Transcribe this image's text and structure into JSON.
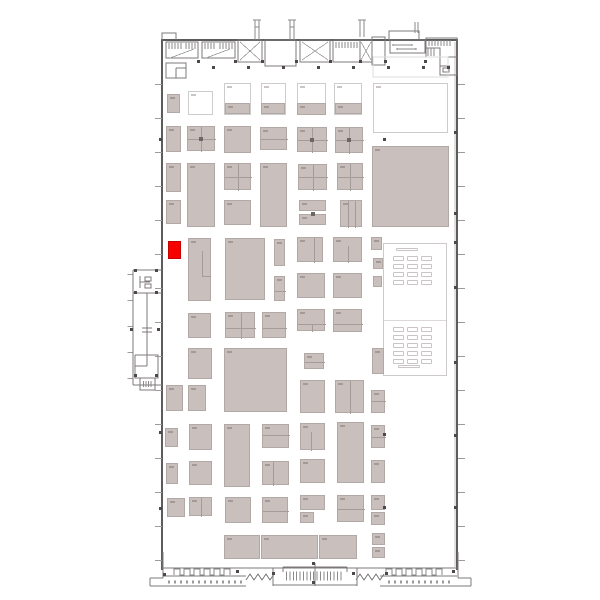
{
  "page": {
    "width": 600,
    "height": 600,
    "background": "#ffffff"
  },
  "colors": {
    "booth_fill": "#c9bfbd",
    "booth_border": "#b2a8a6",
    "outline_border": "#cccccc",
    "highlight": "#f60000",
    "highlight_border": "#c40000",
    "divider": "#a59b99",
    "smudge": "#a39997",
    "smudge_light": "#cdc5c3",
    "wall": "#5c5c5c",
    "line": "#7d7878"
  },
  "floorplan": {
    "hall": {
      "x": 162,
      "y": 38,
      "w": 296,
      "h": 532
    },
    "highlighted_booth": {
      "x": 168,
      "y": 241,
      "w": 13,
      "h": 18,
      "color": "#f60000"
    },
    "booths": [
      {
        "x": 167,
        "y": 94,
        "w": 13,
        "h": 19
      },
      {
        "x": 188,
        "y": 91,
        "w": 25,
        "h": 24,
        "v": "outline"
      },
      {
        "x": 224,
        "y": 83,
        "w": 27,
        "h": 32,
        "v": "outline"
      },
      {
        "x": 225,
        "y": 103,
        "w": 25,
        "h": 11
      },
      {
        "x": 261,
        "y": 83,
        "w": 25,
        "h": 32,
        "v": "outline"
      },
      {
        "x": 261,
        "y": 103,
        "w": 24,
        "h": 11
      },
      {
        "x": 297,
        "y": 83,
        "w": 29,
        "h": 32,
        "v": "outline"
      },
      {
        "x": 297,
        "y": 103,
        "w": 29,
        "h": 12
      },
      {
        "x": 334,
        "y": 83,
        "w": 28,
        "h": 32,
        "v": "outline"
      },
      {
        "x": 335,
        "y": 103,
        "w": 27,
        "h": 11
      },
      {
        "x": 373,
        "y": 83,
        "w": 75,
        "h": 50,
        "v": "outline"
      },
      {
        "x": 166,
        "y": 126,
        "w": 15,
        "h": 26
      },
      {
        "x": 187,
        "y": 126,
        "w": 28,
        "h": 25,
        "bars": [
          [
            13,
            0,
            1,
            25
          ],
          [
            0,
            12,
            28,
            1
          ]
        ],
        "dot": [
          11,
          10
        ]
      },
      {
        "x": 224,
        "y": 126,
        "w": 27,
        "h": 27
      },
      {
        "x": 260,
        "y": 127,
        "w": 27,
        "h": 23,
        "bars": [
          [
            0,
            11,
            27,
            1
          ]
        ]
      },
      {
        "x": 297,
        "y": 127,
        "w": 30,
        "h": 25,
        "bars": [
          [
            14,
            0,
            1,
            25
          ],
          [
            0,
            12,
            30,
            1
          ]
        ],
        "dot": [
          12,
          10
        ]
      },
      {
        "x": 335,
        "y": 127,
        "w": 28,
        "h": 26,
        "bars": [
          [
            13,
            0,
            1,
            26
          ],
          [
            0,
            12,
            28,
            1
          ]
        ],
        "dot": [
          11,
          10
        ]
      },
      {
        "x": 372,
        "y": 146,
        "w": 77,
        "h": 81
      },
      {
        "x": 166,
        "y": 163,
        "w": 15,
        "h": 29
      },
      {
        "x": 187,
        "y": 163,
        "w": 28,
        "h": 64
      },
      {
        "x": 224,
        "y": 163,
        "w": 27,
        "h": 27,
        "bars": [
          [
            13,
            0,
            1,
            27
          ],
          [
            0,
            13,
            27,
            1
          ]
        ]
      },
      {
        "x": 260,
        "y": 163,
        "w": 27,
        "h": 64
      },
      {
        "x": 298,
        "y": 164,
        "w": 29,
        "h": 26,
        "bars": [
          [
            14,
            0,
            1,
            26
          ],
          [
            0,
            12,
            29,
            1
          ]
        ]
      },
      {
        "x": 337,
        "y": 163,
        "w": 26,
        "h": 27,
        "bars": [
          [
            12,
            0,
            1,
            27
          ],
          [
            0,
            13,
            26,
            1
          ]
        ]
      },
      {
        "x": 166,
        "y": 200,
        "w": 15,
        "h": 24
      },
      {
        "x": 224,
        "y": 200,
        "w": 27,
        "h": 25
      },
      {
        "x": 299,
        "y": 200,
        "w": 27,
        "h": 11
      },
      {
        "x": 299,
        "y": 214,
        "w": 27,
        "h": 11,
        "dot": [
          11,
          -3
        ]
      },
      {
        "x": 340,
        "y": 200,
        "w": 22,
        "h": 27,
        "bars": [
          [
            7,
            0,
            1,
            27
          ],
          [
            14,
            0,
            1,
            27
          ]
        ]
      },
      {
        "x": 168,
        "y": 241,
        "w": 13,
        "h": 18,
        "v": "highlight"
      },
      {
        "x": 188,
        "y": 238,
        "w": 23,
        "h": 63,
        "bars": [
          [
            13,
            12,
            1,
            26
          ],
          [
            13,
            37,
            9,
            1
          ]
        ]
      },
      {
        "x": 225,
        "y": 238,
        "w": 40,
        "h": 62
      },
      {
        "x": 274,
        "y": 239,
        "w": 11,
        "h": 27
      },
      {
        "x": 274,
        "y": 276,
        "w": 11,
        "h": 25,
        "bars": [
          [
            0,
            14,
            11,
            1
          ]
        ]
      },
      {
        "x": 297,
        "y": 237,
        "w": 26,
        "h": 25,
        "bars": [
          [
            16,
            0,
            1,
            25
          ]
        ]
      },
      {
        "x": 333,
        "y": 237,
        "w": 29,
        "h": 25,
        "bars": [
          [
            14,
            8,
            1,
            17
          ]
        ]
      },
      {
        "x": 297,
        "y": 273,
        "w": 28,
        "h": 25
      },
      {
        "x": 333,
        "y": 273,
        "w": 29,
        "h": 25
      },
      {
        "x": 371,
        "y": 237,
        "w": 11,
        "h": 13
      },
      {
        "x": 373,
        "y": 258,
        "w": 10,
        "h": 11
      },
      {
        "x": 373,
        "y": 276,
        "w": 9,
        "h": 11
      },
      {
        "x": 188,
        "y": 313,
        "w": 23,
        "h": 25
      },
      {
        "x": 225,
        "y": 312,
        "w": 30,
        "h": 26,
        "bars": [
          [
            15,
            0,
            1,
            26
          ],
          [
            0,
            15,
            30,
            1
          ]
        ]
      },
      {
        "x": 262,
        "y": 312,
        "w": 24,
        "h": 26,
        "bars": [
          [
            0,
            15,
            24,
            1
          ]
        ]
      },
      {
        "x": 297,
        "y": 309,
        "w": 28,
        "h": 22,
        "bars": [
          [
            0,
            14,
            28,
            1
          ],
          [
            14,
            14,
            1,
            8
          ]
        ]
      },
      {
        "x": 333,
        "y": 309,
        "w": 29,
        "h": 23,
        "bars": [
          [
            0,
            14,
            29,
            1
          ]
        ]
      },
      {
        "x": 188,
        "y": 348,
        "w": 24,
        "h": 31
      },
      {
        "x": 224,
        "y": 348,
        "w": 63,
        "h": 64
      },
      {
        "x": 304,
        "y": 353,
        "w": 20,
        "h": 16,
        "bars": [
          [
            0,
            8,
            20,
            1
          ]
        ]
      },
      {
        "x": 372,
        "y": 348,
        "w": 12,
        "h": 26
      },
      {
        "x": 166,
        "y": 385,
        "w": 17,
        "h": 26
      },
      {
        "x": 188,
        "y": 385,
        "w": 18,
        "h": 26
      },
      {
        "x": 300,
        "y": 380,
        "w": 25,
        "h": 33
      },
      {
        "x": 335,
        "y": 380,
        "w": 29,
        "h": 33,
        "bars": [
          [
            14,
            0,
            1,
            33
          ]
        ]
      },
      {
        "x": 371,
        "y": 390,
        "w": 14,
        "h": 23,
        "bars": [
          [
            0,
            10,
            14,
            1
          ]
        ]
      },
      {
        "x": 165,
        "y": 428,
        "w": 13,
        "h": 19
      },
      {
        "x": 189,
        "y": 424,
        "w": 23,
        "h": 26
      },
      {
        "x": 224,
        "y": 424,
        "w": 26,
        "h": 63
      },
      {
        "x": 262,
        "y": 424,
        "w": 27,
        "h": 24,
        "bars": [
          [
            0,
            10,
            27,
            1
          ]
        ]
      },
      {
        "x": 300,
        "y": 423,
        "w": 25,
        "h": 27,
        "bars": [
          [
            10,
            8,
            1,
            19
          ]
        ]
      },
      {
        "x": 337,
        "y": 422,
        "w": 27,
        "h": 61
      },
      {
        "x": 371,
        "y": 425,
        "w": 14,
        "h": 23,
        "bars": [
          [
            0,
            11,
            14,
            1
          ]
        ]
      },
      {
        "x": 166,
        "y": 463,
        "w": 12,
        "h": 21
      },
      {
        "x": 189,
        "y": 461,
        "w": 23,
        "h": 24
      },
      {
        "x": 262,
        "y": 461,
        "w": 27,
        "h": 24,
        "bars": [
          [
            10,
            0,
            1,
            24
          ]
        ]
      },
      {
        "x": 300,
        "y": 459,
        "w": 25,
        "h": 24
      },
      {
        "x": 371,
        "y": 460,
        "w": 14,
        "h": 23
      },
      {
        "x": 167,
        "y": 498,
        "w": 18,
        "h": 19
      },
      {
        "x": 189,
        "y": 497,
        "w": 23,
        "h": 19,
        "bars": [
          [
            11,
            0,
            1,
            19
          ]
        ]
      },
      {
        "x": 225,
        "y": 497,
        "w": 26,
        "h": 26
      },
      {
        "x": 262,
        "y": 497,
        "w": 26,
        "h": 26,
        "bars": [
          [
            0,
            13,
            26,
            1
          ]
        ]
      },
      {
        "x": 300,
        "y": 495,
        "w": 25,
        "h": 15
      },
      {
        "x": 300,
        "y": 512,
        "w": 14,
        "h": 11
      },
      {
        "x": 337,
        "y": 495,
        "w": 27,
        "h": 27,
        "bars": [
          [
            0,
            13,
            27,
            1
          ]
        ]
      },
      {
        "x": 371,
        "y": 495,
        "w": 14,
        "h": 15
      },
      {
        "x": 371,
        "y": 512,
        "w": 14,
        "h": 13
      },
      {
        "x": 224,
        "y": 535,
        "w": 36,
        "h": 24
      },
      {
        "x": 261,
        "y": 535,
        "w": 57,
        "h": 24
      },
      {
        "x": 319,
        "y": 535,
        "w": 38,
        "h": 24
      },
      {
        "x": 372,
        "y": 533,
        "w": 13,
        "h": 12
      },
      {
        "x": 372,
        "y": 547,
        "w": 13,
        "h": 11
      }
    ],
    "columns": [
      [
        212,
        66
      ],
      [
        247,
        66
      ],
      [
        282,
        66
      ],
      [
        317,
        66
      ],
      [
        352,
        66
      ],
      [
        387,
        66
      ],
      [
        422,
        66
      ],
      [
        447,
        66
      ],
      [
        197,
        60
      ],
      [
        234,
        60
      ],
      [
        261,
        60
      ],
      [
        295,
        60
      ],
      [
        329,
        60
      ],
      [
        359,
        60
      ],
      [
        384,
        60
      ],
      [
        424,
        60
      ],
      [
        159,
        138
      ],
      [
        159,
        431
      ],
      [
        159,
        507
      ],
      [
        454,
        131
      ],
      [
        454,
        212
      ],
      [
        454,
        241
      ],
      [
        454,
        286
      ],
      [
        454,
        361
      ],
      [
        454,
        434
      ],
      [
        454,
        506
      ],
      [
        383,
        138
      ],
      [
        383,
        433
      ],
      [
        383,
        506
      ],
      [
        134,
        269
      ],
      [
        155,
        269
      ],
      [
        134,
        291
      ],
      [
        155,
        291
      ],
      [
        130,
        328
      ],
      [
        157,
        328
      ],
      [
        134,
        374
      ],
      [
        155,
        374
      ],
      [
        163,
        573
      ],
      [
        236,
        570
      ],
      [
        272,
        572
      ],
      [
        312,
        562
      ],
      [
        312,
        581
      ],
      [
        352,
        572
      ],
      [
        385,
        572
      ],
      [
        452,
        570
      ]
    ],
    "seating": {
      "x": 383,
      "y": 243,
      "w": 64,
      "h": 133,
      "divider_y": 76,
      "cols": [
        392,
        406,
        420
      ],
      "table_w": 11,
      "table_h": 5,
      "sections": [
        {
          "y0": 255,
          "rows": 4,
          "gap": 8
        },
        {
          "y0": 326,
          "rows": 5,
          "gap": 8
        }
      ],
      "wide_tables": [
        [
          395,
          247,
          22,
          3
        ],
        [
          397,
          364,
          22,
          3
        ]
      ]
    }
  }
}
